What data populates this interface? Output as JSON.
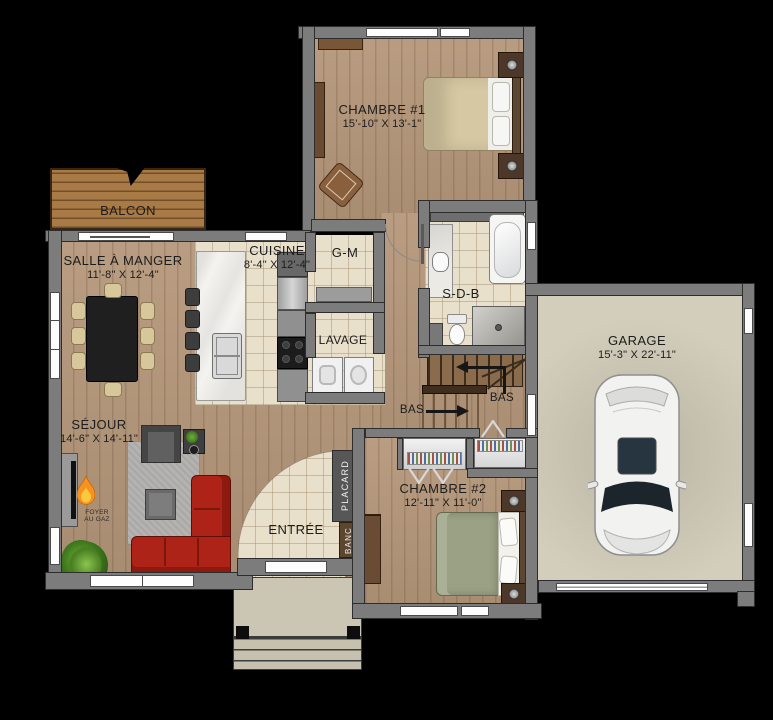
{
  "plan": {
    "rooms": {
      "chambre1": {
        "name": "CHAMBRE #1",
        "dims": "15'-10\" X 13'-1\""
      },
      "balcon": {
        "name": "BALCON"
      },
      "salle_a_manger": {
        "name": "SALLE À MANGER",
        "dims": "11'-8\" X 12'-4\""
      },
      "cuisine": {
        "name": "CUISINE",
        "dims": "8'-4\" X 12'-4\""
      },
      "garde_manger": {
        "name": "G-M"
      },
      "salle_de_bain": {
        "name": "S-D-B"
      },
      "lavage": {
        "name": "LAVAGE"
      },
      "sejour": {
        "name": "SÉJOUR",
        "dims": "14'-6\" X 14'-11\""
      },
      "entree": {
        "name": "ENTRÉE"
      },
      "chambre2": {
        "name": "CHAMBRE #2",
        "dims": "12'-11\" X 11'-0\""
      },
      "garage": {
        "name": "GARAGE",
        "dims": "15'-3\" X 22'-11\""
      }
    },
    "annotations": {
      "placard": "PLACARD",
      "banc": "BANC",
      "foyer_line1": "FOYER",
      "foyer_line2": "AU GAZ",
      "stairs_down_1": "BAS",
      "stairs_down_2": "BAS"
    },
    "colors": {
      "background": "#000000",
      "wall": "#7c7c7c",
      "wood_floor": "#b5977a",
      "tile_floor": "#e9e0cb",
      "garage_floor": "#d3cdbc",
      "deck": "#a87a46",
      "sofa_red": "#ae2317",
      "bed1_tan": "#d6c8a2",
      "bed2_sage": "#9aa184",
      "label_text": "#1c1c1c"
    }
  }
}
